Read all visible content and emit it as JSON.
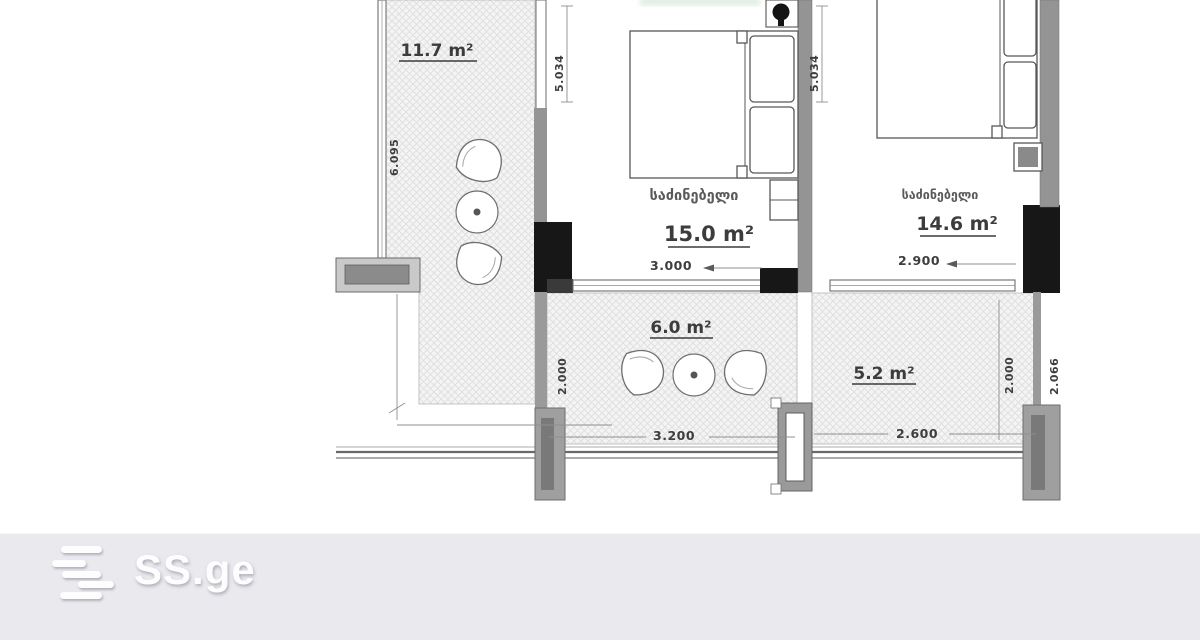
{
  "plan": {
    "balcony_left": {
      "area": "11.7 m²",
      "total_height_dim": "6.095"
    },
    "bedroom1": {
      "name": "საძინებელი",
      "area": "15.0 m²",
      "width_dim": "3.000",
      "wall_dim": "5.034"
    },
    "bedroom2": {
      "name": "საძინებელი",
      "area": "14.6 m²",
      "width_dim": "2.900",
      "wall_dim": "5.034"
    },
    "balcony_center": {
      "area": "6.0 m²",
      "width_dim": "3.200",
      "depth_dim": "2.000"
    },
    "balcony_right": {
      "area": "5.2 m²",
      "width_dim": "2.600",
      "depth_dim": "2.000",
      "edge_dim": "2.066"
    }
  },
  "footer": {
    "brand": "SS.ge"
  },
  "colors": {
    "background": "#ffffff",
    "hatch_fill": "#f4f4f4",
    "hatch_line": "#dedede",
    "wall_gray": "#949494",
    "wall_black": "#171717",
    "line": "#5a5a5a",
    "text": "#3c3c3c",
    "footer_bg": "#e9e9ee",
    "logo": "#fdfdfe"
  }
}
